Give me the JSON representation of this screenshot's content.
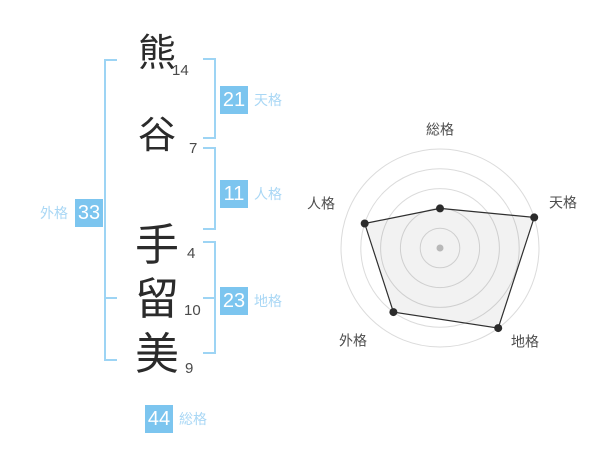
{
  "name_analysis": {
    "surname": [
      {
        "char": "熊",
        "strokes": "14"
      },
      {
        "char": "谷",
        "strokes": "7"
      }
    ],
    "given_name": [
      {
        "char": "手",
        "strokes": "4"
      },
      {
        "char": "留",
        "strokes": "10"
      },
      {
        "char": "美",
        "strokes": "9"
      }
    ],
    "kaku": {
      "tenkaku": {
        "label": "天格",
        "value": "21"
      },
      "jinkaku": {
        "label": "人格",
        "value": "11"
      },
      "chikaku": {
        "label": "地格",
        "value": "23"
      },
      "gaikaku": {
        "label": "外格",
        "value": "33"
      },
      "soukaku": {
        "label": "総格",
        "value": "44"
      }
    }
  },
  "chart_data": {
    "type": "radar",
    "axes": [
      "総格",
      "天格",
      "地格",
      "外格",
      "人格"
    ],
    "values": [
      2,
      5,
      5,
      4,
      4
    ],
    "max": 5,
    "rings": 5,
    "grid": "concentric-circles",
    "legend": "none",
    "ring_color": "#dbdbdb",
    "polygon_stroke": "#2f2f2f",
    "polygon_fill": "rgba(0,0,0,0.05)",
    "point_color": "#2b2b2b",
    "center_dot_color": "#c2c2c2",
    "label_color": "#4d4d4d"
  },
  "colors": {
    "accent_box": "#7cc5ef",
    "accent_label": "#a9d7f5",
    "bracket": "#9dd4f4",
    "text_dark": "#2b2b2b"
  }
}
